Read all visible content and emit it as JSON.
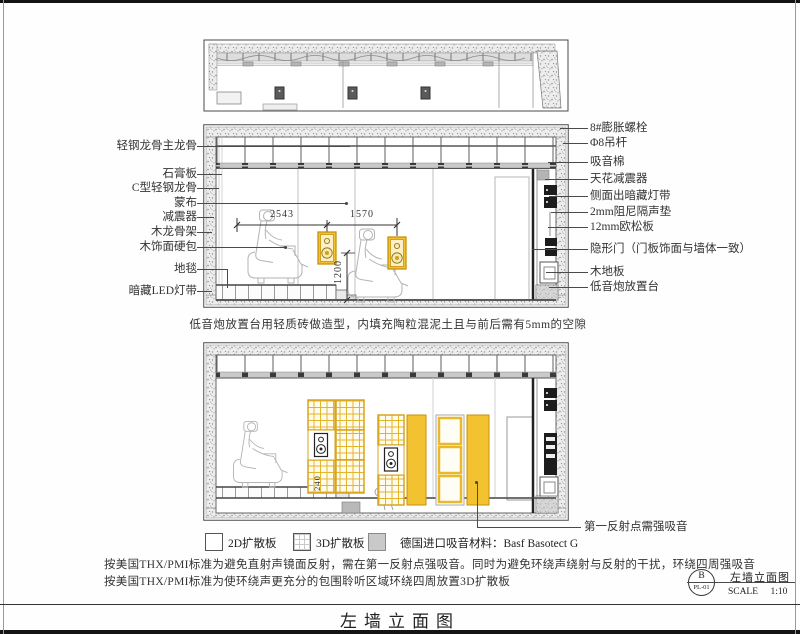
{
  "colors": {
    "yellow": "#F2C230",
    "yellow-dk": "#C8920A",
    "ink": "#2E2E2E"
  },
  "sheet": {
    "bottom_title": "左墙立面图"
  },
  "labels_left": [
    {
      "text": "轻钢龙骨主龙骨"
    },
    {
      "text": "石膏板"
    },
    {
      "text": "C型轻钢龙骨"
    },
    {
      "text": "蒙布"
    },
    {
      "text": "减震器"
    },
    {
      "text": "木龙骨架"
    },
    {
      "text": "木饰面硬包"
    },
    {
      "text": "地毯"
    },
    {
      "text": "暗藏LED灯带"
    }
  ],
  "labels_right": [
    {
      "text": "8#膨胀螺栓"
    },
    {
      "text": "Φ8吊杆"
    },
    {
      "text": "吸音棉"
    },
    {
      "text": "天花减震器"
    },
    {
      "text": "侧面出暗藏灯带"
    },
    {
      "text": "2mm阻尼隔声垫"
    },
    {
      "text": "12mm欧松板"
    },
    {
      "text": "隐形门（门板饰面与墙体一致）"
    },
    {
      "text": "木地板"
    },
    {
      "text": "低音炮放置台"
    }
  ],
  "view_a": {
    "caption": "低音炮放置台用轻质砖做造型，内填充陶粒混泥土且与前后需有5mm的空隙",
    "dims": {
      "d1": "2543",
      "d2": "1570",
      "v1": "1200"
    }
  },
  "view_b": {
    "dims": {
      "v1": "240"
    },
    "callout": "第一反射点需强吸音"
  },
  "legend": {
    "items": [
      {
        "swatch": "plain",
        "label": "2D扩散板"
      },
      {
        "swatch": "grid",
        "label": "3D扩散板"
      },
      {
        "swatch": "solid",
        "label": "德国进口吸音材料：Basf Basotect G"
      }
    ]
  },
  "notes": [
    "按美国THX/PMI标准为避免直射声镜面反射，需在第一反射点强吸音。同时为避免环绕声绕射与反射的干扰，环绕四周强吸音",
    "按美国THX/PMI标准为使环绕声更充分的包围聆听区域环绕四周放置3D扩散板"
  ],
  "titleblock": {
    "detail_code": "B",
    "sheet_no": "PL-01",
    "title": "左墙立面图",
    "scale_word": "SCALE",
    "scale_value": "1:10"
  }
}
